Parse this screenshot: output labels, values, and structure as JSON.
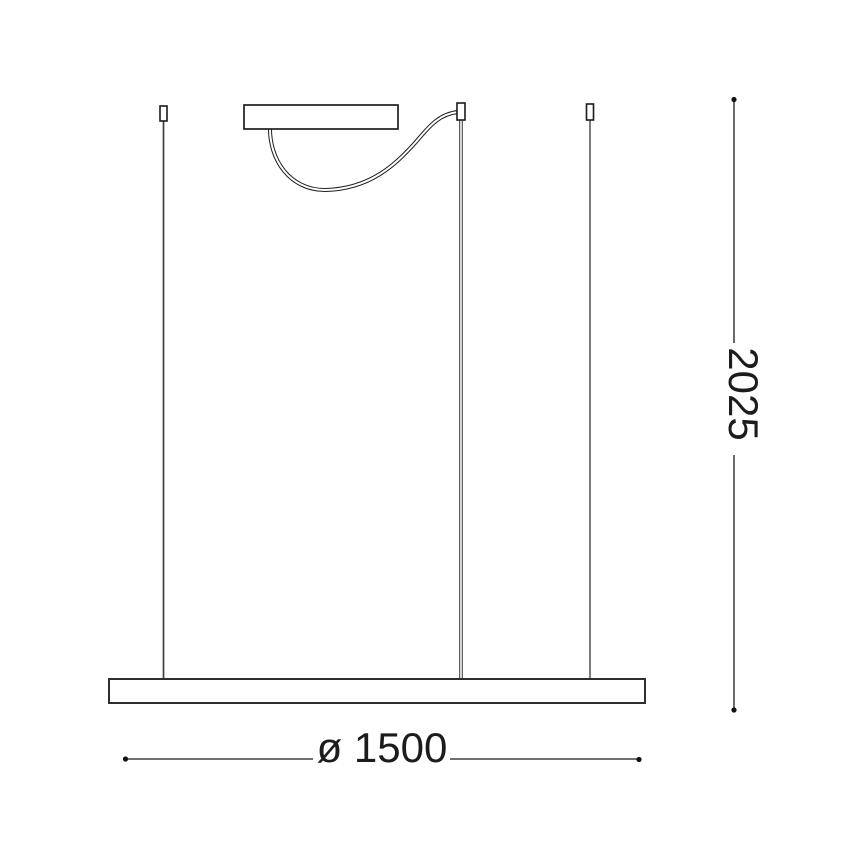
{
  "dimensions": {
    "height_label": "2025",
    "diameter_label": "ø 1500"
  },
  "colors": {
    "background": "#ffffff",
    "line": "#1f1f1f",
    "wire_left": "#3f3f3f",
    "wire_right": "#6e6e6e",
    "dimension": "#1a1a1a"
  }
}
